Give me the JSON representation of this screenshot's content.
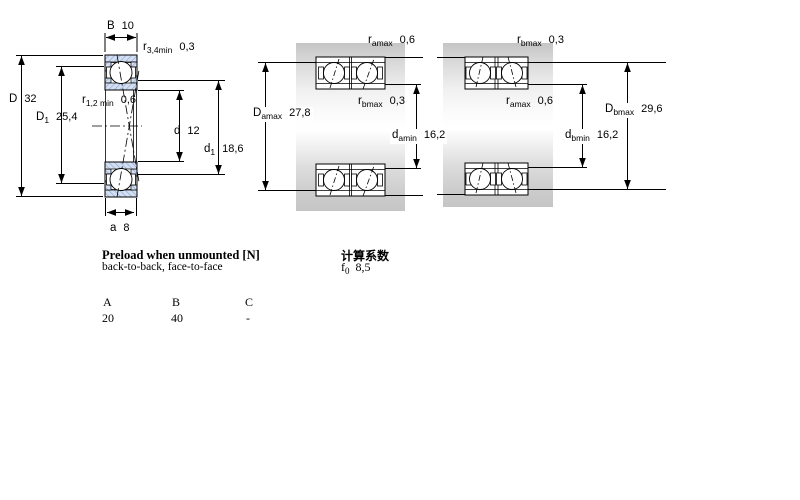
{
  "figure": {
    "left": {
      "B": {
        "sym": "B",
        "sub": "",
        "val": "10"
      },
      "r34": {
        "sym": "r",
        "sub": "3,4min",
        "val": "0,3"
      },
      "D": {
        "sym": "D",
        "sub": "",
        "val": "32"
      },
      "D1": {
        "sym": "D",
        "sub": "1",
        "val": "25,4"
      },
      "r12": {
        "sym": "r",
        "sub": "1,2 min",
        "val": "0,6"
      },
      "d": {
        "sym": "d",
        "sub": "",
        "val": "12"
      },
      "d1": {
        "sym": "d",
        "sub": "1",
        "val": "18,6"
      },
      "a": {
        "sym": "a",
        "sub": "",
        "val": "8"
      }
    },
    "middle": {
      "ramax": {
        "sym": "r",
        "sub": "amax",
        "val": "0,6"
      },
      "rbmax": {
        "sym": "r",
        "sub": "bmax",
        "val": "0,3"
      },
      "Damax": {
        "sym": "D",
        "sub": "amax",
        "val": "27,8"
      },
      "damin": {
        "sym": "d",
        "sub": "amin",
        "val": "16,2"
      }
    },
    "right": {
      "rbmax": {
        "sym": "r",
        "sub": "bmax",
        "val": "0,3"
      },
      "ramax": {
        "sym": "r",
        "sub": "amax",
        "val": "0,6"
      },
      "Dbmax": {
        "sym": "D",
        "sub": "bmax",
        "val": "29,6"
      },
      "dbmin": {
        "sym": "d",
        "sub": "bmin",
        "val": "16,2"
      }
    }
  },
  "preload": {
    "title": "Preload when unmounted [N]",
    "subtitle": "back-to-back, face-to-face",
    "col_headers": [
      "A",
      "B",
      "C"
    ],
    "values": [
      "20",
      "40",
      "-"
    ]
  },
  "factors": {
    "title": "计算系数",
    "f0": {
      "sym": "f",
      "sub": "0",
      "val": "8,5"
    }
  },
  "colors": {
    "ring_fill": "#d4dff2",
    "ring_hatch": "#8aa2cc",
    "steel_gray": "#c9c9c9",
    "line": "#000000"
  }
}
